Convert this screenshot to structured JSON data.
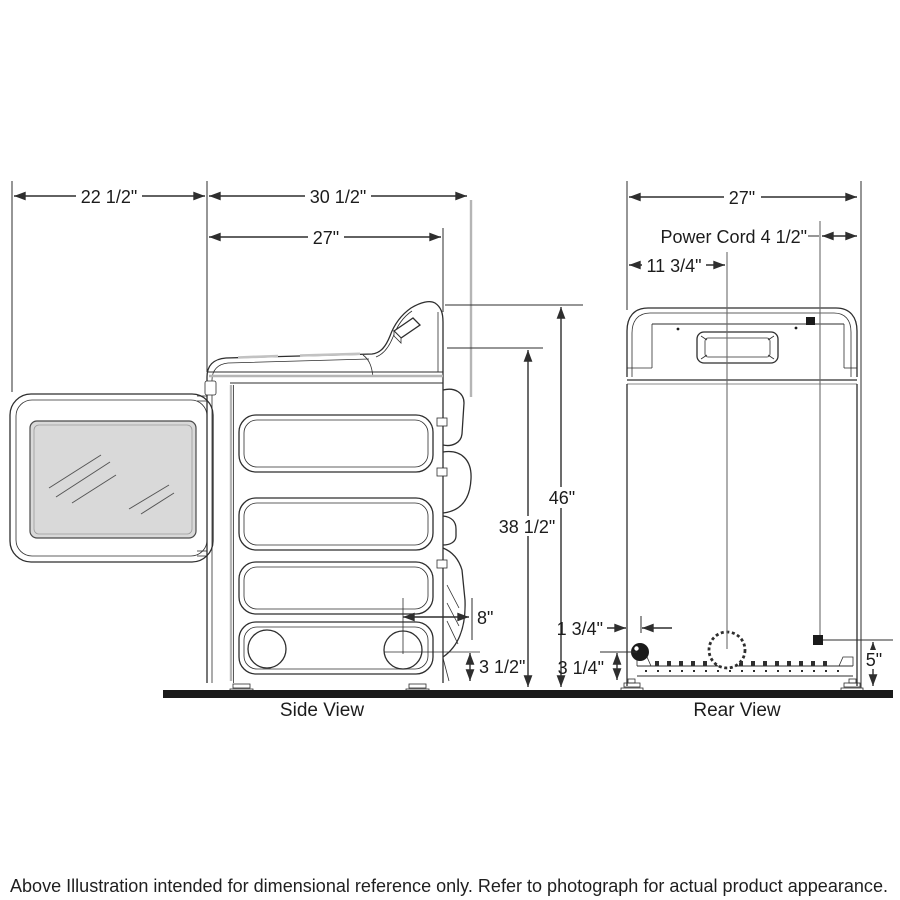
{
  "diagram": {
    "side": {
      "caption": "Side View",
      "door_depth": "22 1/2\"",
      "total_depth": "30 1/2\"",
      "cabinet_depth": "27\"",
      "height_total": "46\"",
      "height_lid": "38 1/2\"",
      "exhaust_offset": "8\"",
      "exhaust_height": "3 1/2\""
    },
    "rear": {
      "caption": "Rear View",
      "width": "27\"",
      "power_cord": "Power Cord 4 1/2\"",
      "vent_offset": "11 3/4\"",
      "power_offset": "1 3/4\"",
      "power_height": "3 1/4\"",
      "cord_height": "5\""
    },
    "footer": "Above Illustration intended for dimensional reference only. Refer to photograph for actual product appearance."
  }
}
